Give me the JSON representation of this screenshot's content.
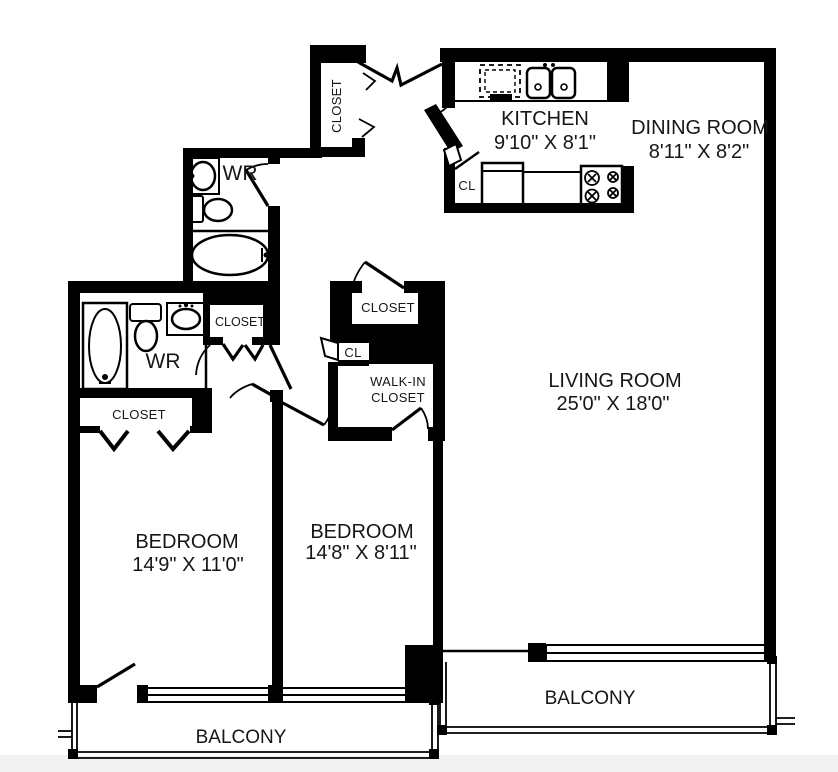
{
  "title": "Two-bedroom apartment floor plan",
  "rooms": {
    "kitchen": {
      "name": "KITCHEN",
      "dims": "9'10\" X 8'1\""
    },
    "dining_room": {
      "name": "DINING ROOM",
      "dims": "8'11\" X 8'2\""
    },
    "living_room": {
      "name": "LIVING ROOM",
      "dims": "25'0\" X 18'0\""
    },
    "bedroom_1": {
      "name": "BEDROOM",
      "dims": "14'9\" X 11'0\""
    },
    "bedroom_2": {
      "name": "BEDROOM",
      "dims": "14'8\" X 8'11\""
    }
  },
  "labels": {
    "entry_closet": "CLOSET",
    "hall_closet": "CLOSET",
    "bedroom1_closet": "CLOSET",
    "bedroom2_closet": "CLOSET",
    "walk_in_line1": "WALK-IN",
    "walk_in_line2": "CLOSET",
    "kitchen_cl": "CL",
    "hall_cl": "CL",
    "washroom_upper": "WR",
    "washroom_lower": "WR",
    "balcony_left": "BALCONY",
    "balcony_right": "BALCONY"
  },
  "fixtures": [
    "bathtub",
    "toilet",
    "vanity-sink",
    "double-kitchen-sink",
    "dishwasher",
    "refrigerator",
    "stove",
    "bathtub-lower",
    "toilet-lower",
    "vanity-sink-lower"
  ],
  "colors": {
    "wall": "#000000",
    "background": "#ffffff",
    "bottom_strip": "#f2f2f2",
    "text": "#161616"
  }
}
